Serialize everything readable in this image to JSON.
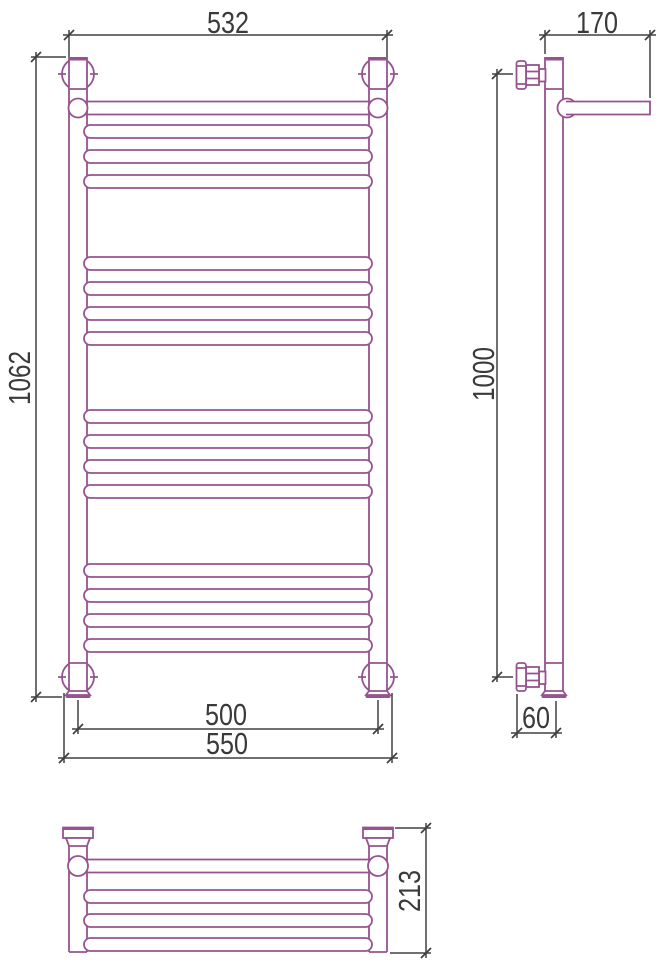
{
  "colors": {
    "outline": "#96538f",
    "dimension": "#414141",
    "text": "#3a3a3a",
    "background": "#ffffff"
  },
  "dimensions": {
    "front_width_outer": "532",
    "front_height_overall": "1062",
    "front_bottom_centers": "500",
    "front_bottom_overall": "550",
    "side_depth_top": "170",
    "side_height_centers": "1000",
    "side_bottom_offset": "60",
    "top_view_depth": "213"
  }
}
